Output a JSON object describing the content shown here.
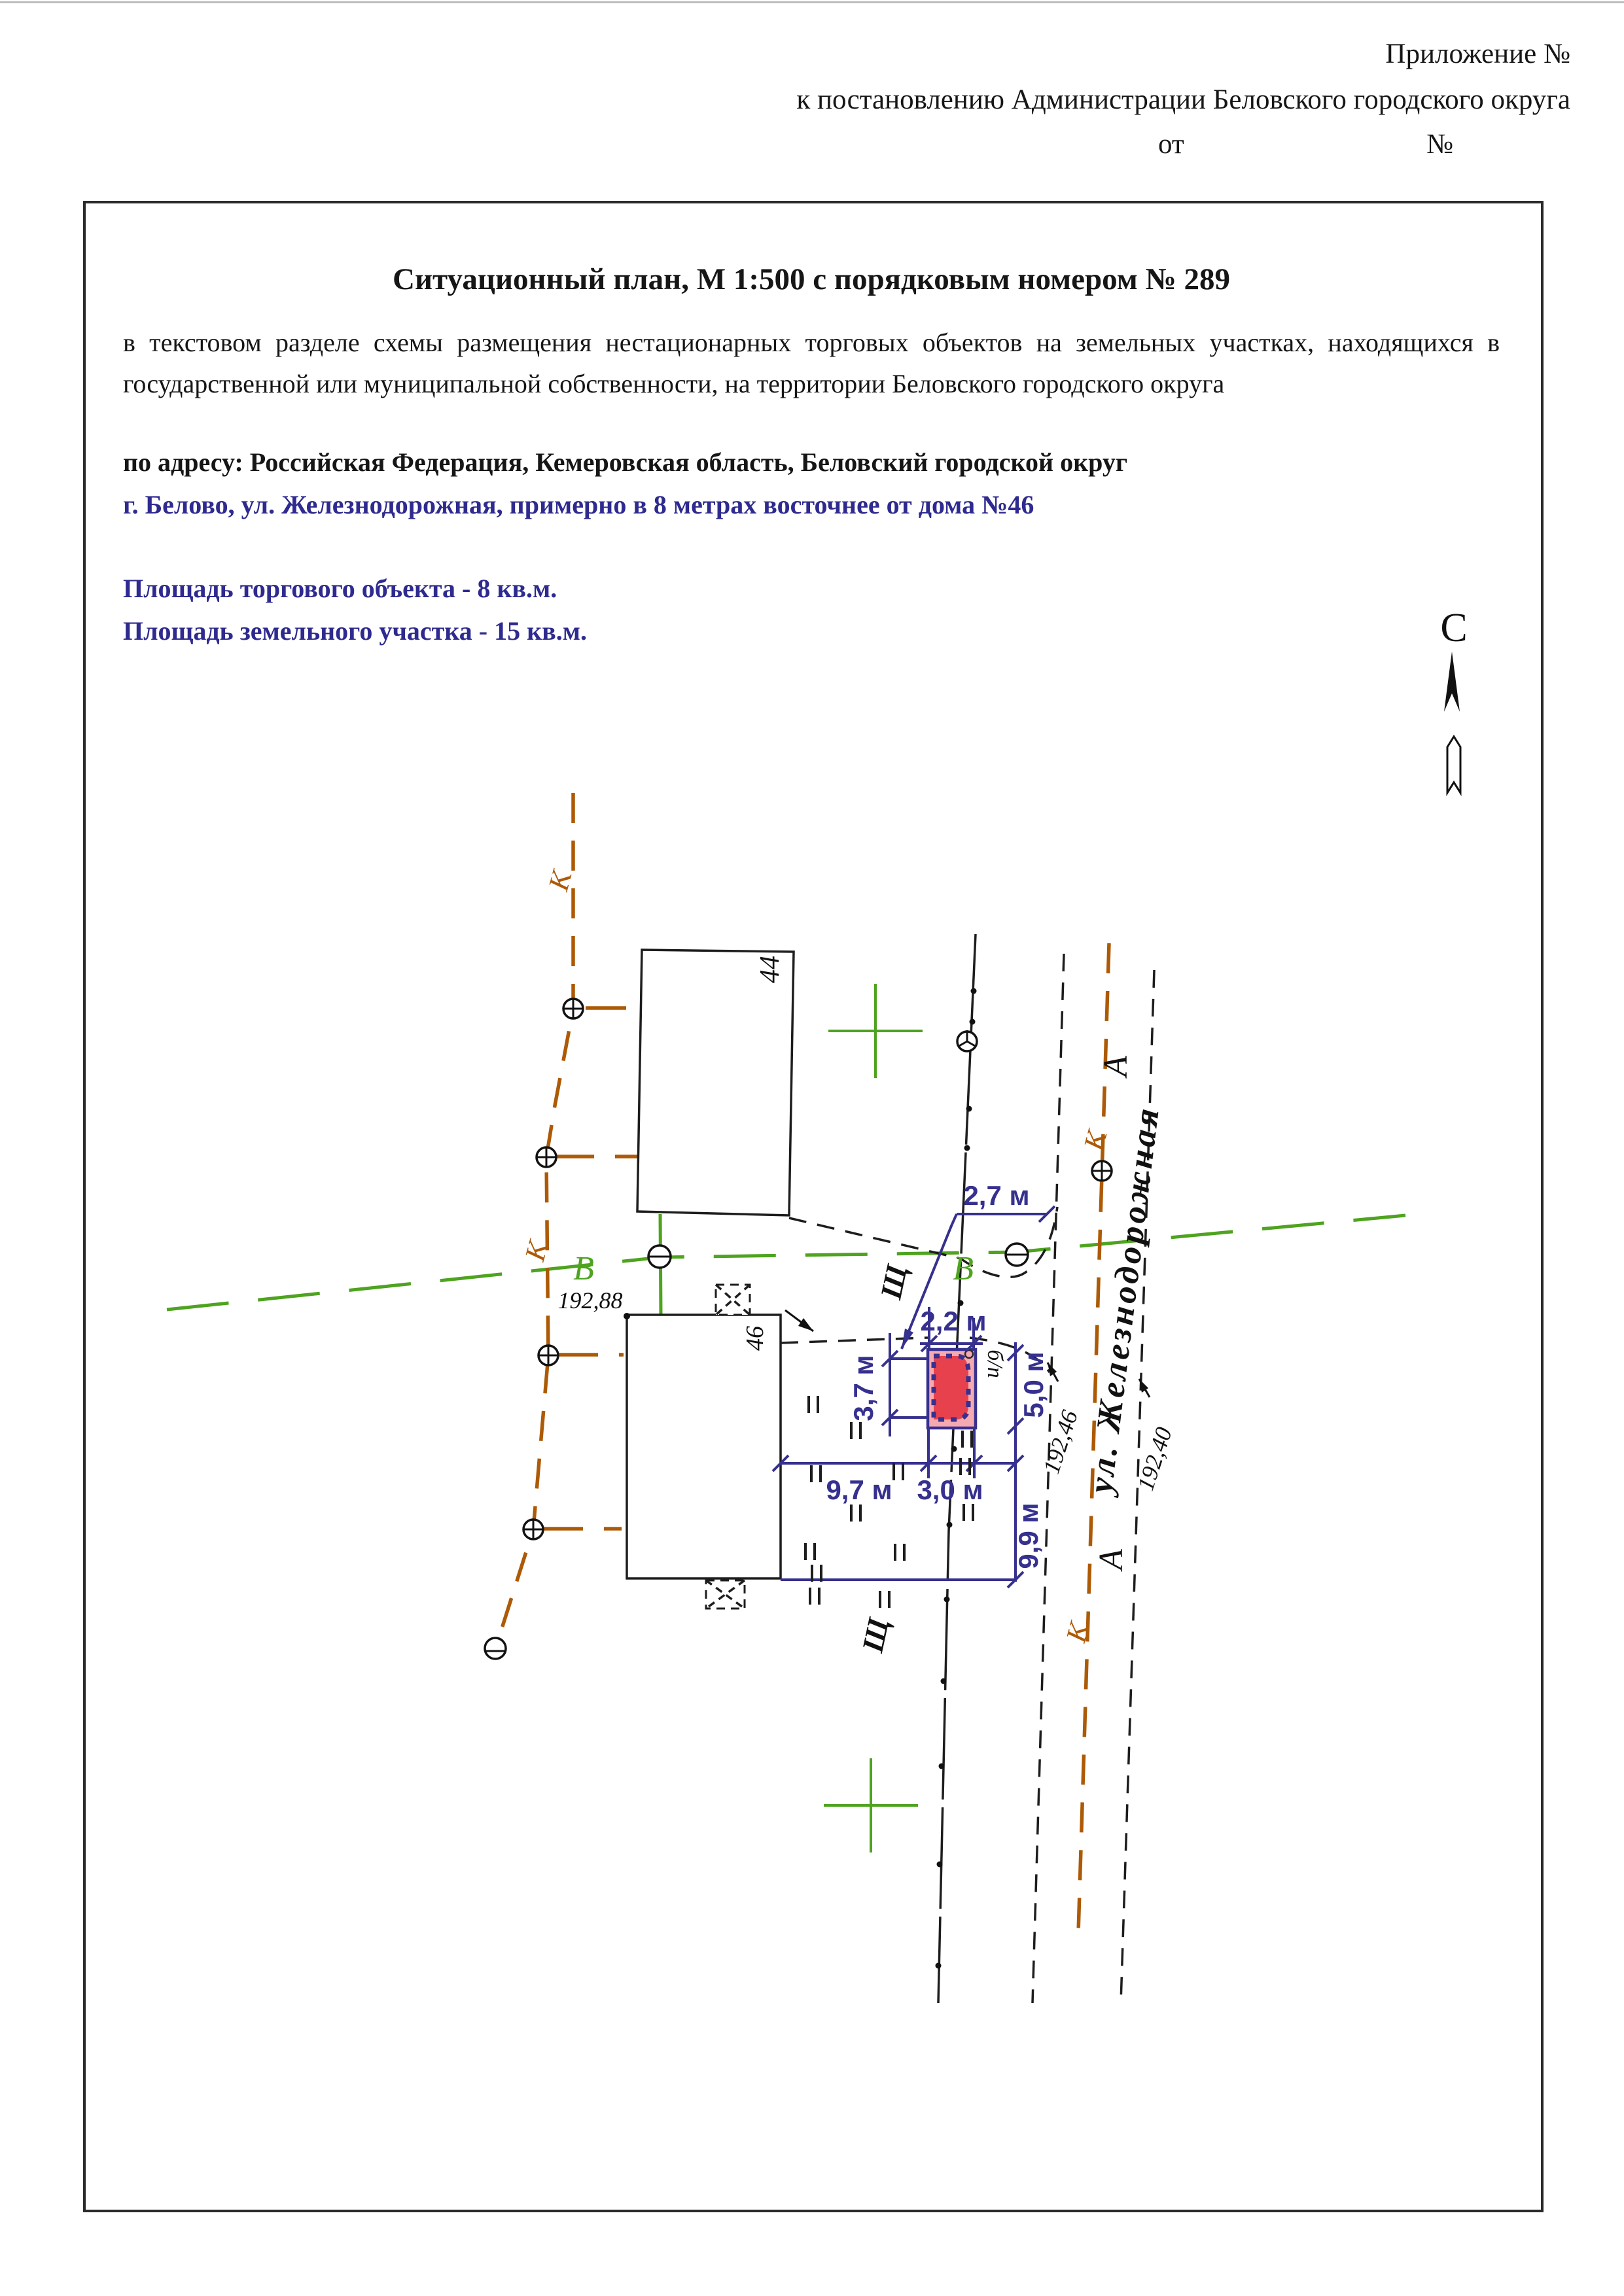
{
  "header": {
    "line1": "Приложение №",
    "line2": "к постановлению Администрации Беловского городского округа",
    "line3_left": "от",
    "line3_right": "№"
  },
  "document": {
    "title": "Ситуационный план, М 1:500 с порядковым номером № 289",
    "paragraph": "в текстовом разделе схемы размещения нестационарных торговых объектов на земельных  участках, находящихся в государственной или муниципальной собственности, на территории Беловского городского округа",
    "address_black": "по адресу: Российская Федерация, Кемеровская область, Беловский городской округ",
    "address_blue": "г. Белово, ул. Железнодорожная, примерно в 8 метрах восточнее от дома №46",
    "area_object": "Площадь торгового объекта - 8 кв.м.",
    "area_land": "Площадь земельного участка - 15 кв.м."
  },
  "compass": {
    "north_label": "С"
  },
  "plan": {
    "house44": "44",
    "house46": "46",
    "elev_nw": "192,88",
    "elev_road1": "192,46",
    "elev_road2": "192,40",
    "street_name": "ул. Железнодорожная",
    "road_marker_a": "А",
    "comm_k": "К",
    "comm_v": "В",
    "surface_shch": "Щ",
    "object_note": "б/п",
    "dims": {
      "d27": "2,7 м",
      "d22": "2,2 м",
      "d37": "3,7 м",
      "d50": "5,0 м",
      "d97": "9,7 м",
      "d30": "3,0 м",
      "d99": "9,9 м"
    },
    "colors": {
      "dimension_blue": "#36308e",
      "object_red": "#e8414e",
      "plot_pink": "#f5a9b1",
      "utility_brown": "#ad5a06",
      "water_green": "#4ea31f",
      "doc_blue_text": "#2e2a8f"
    }
  }
}
